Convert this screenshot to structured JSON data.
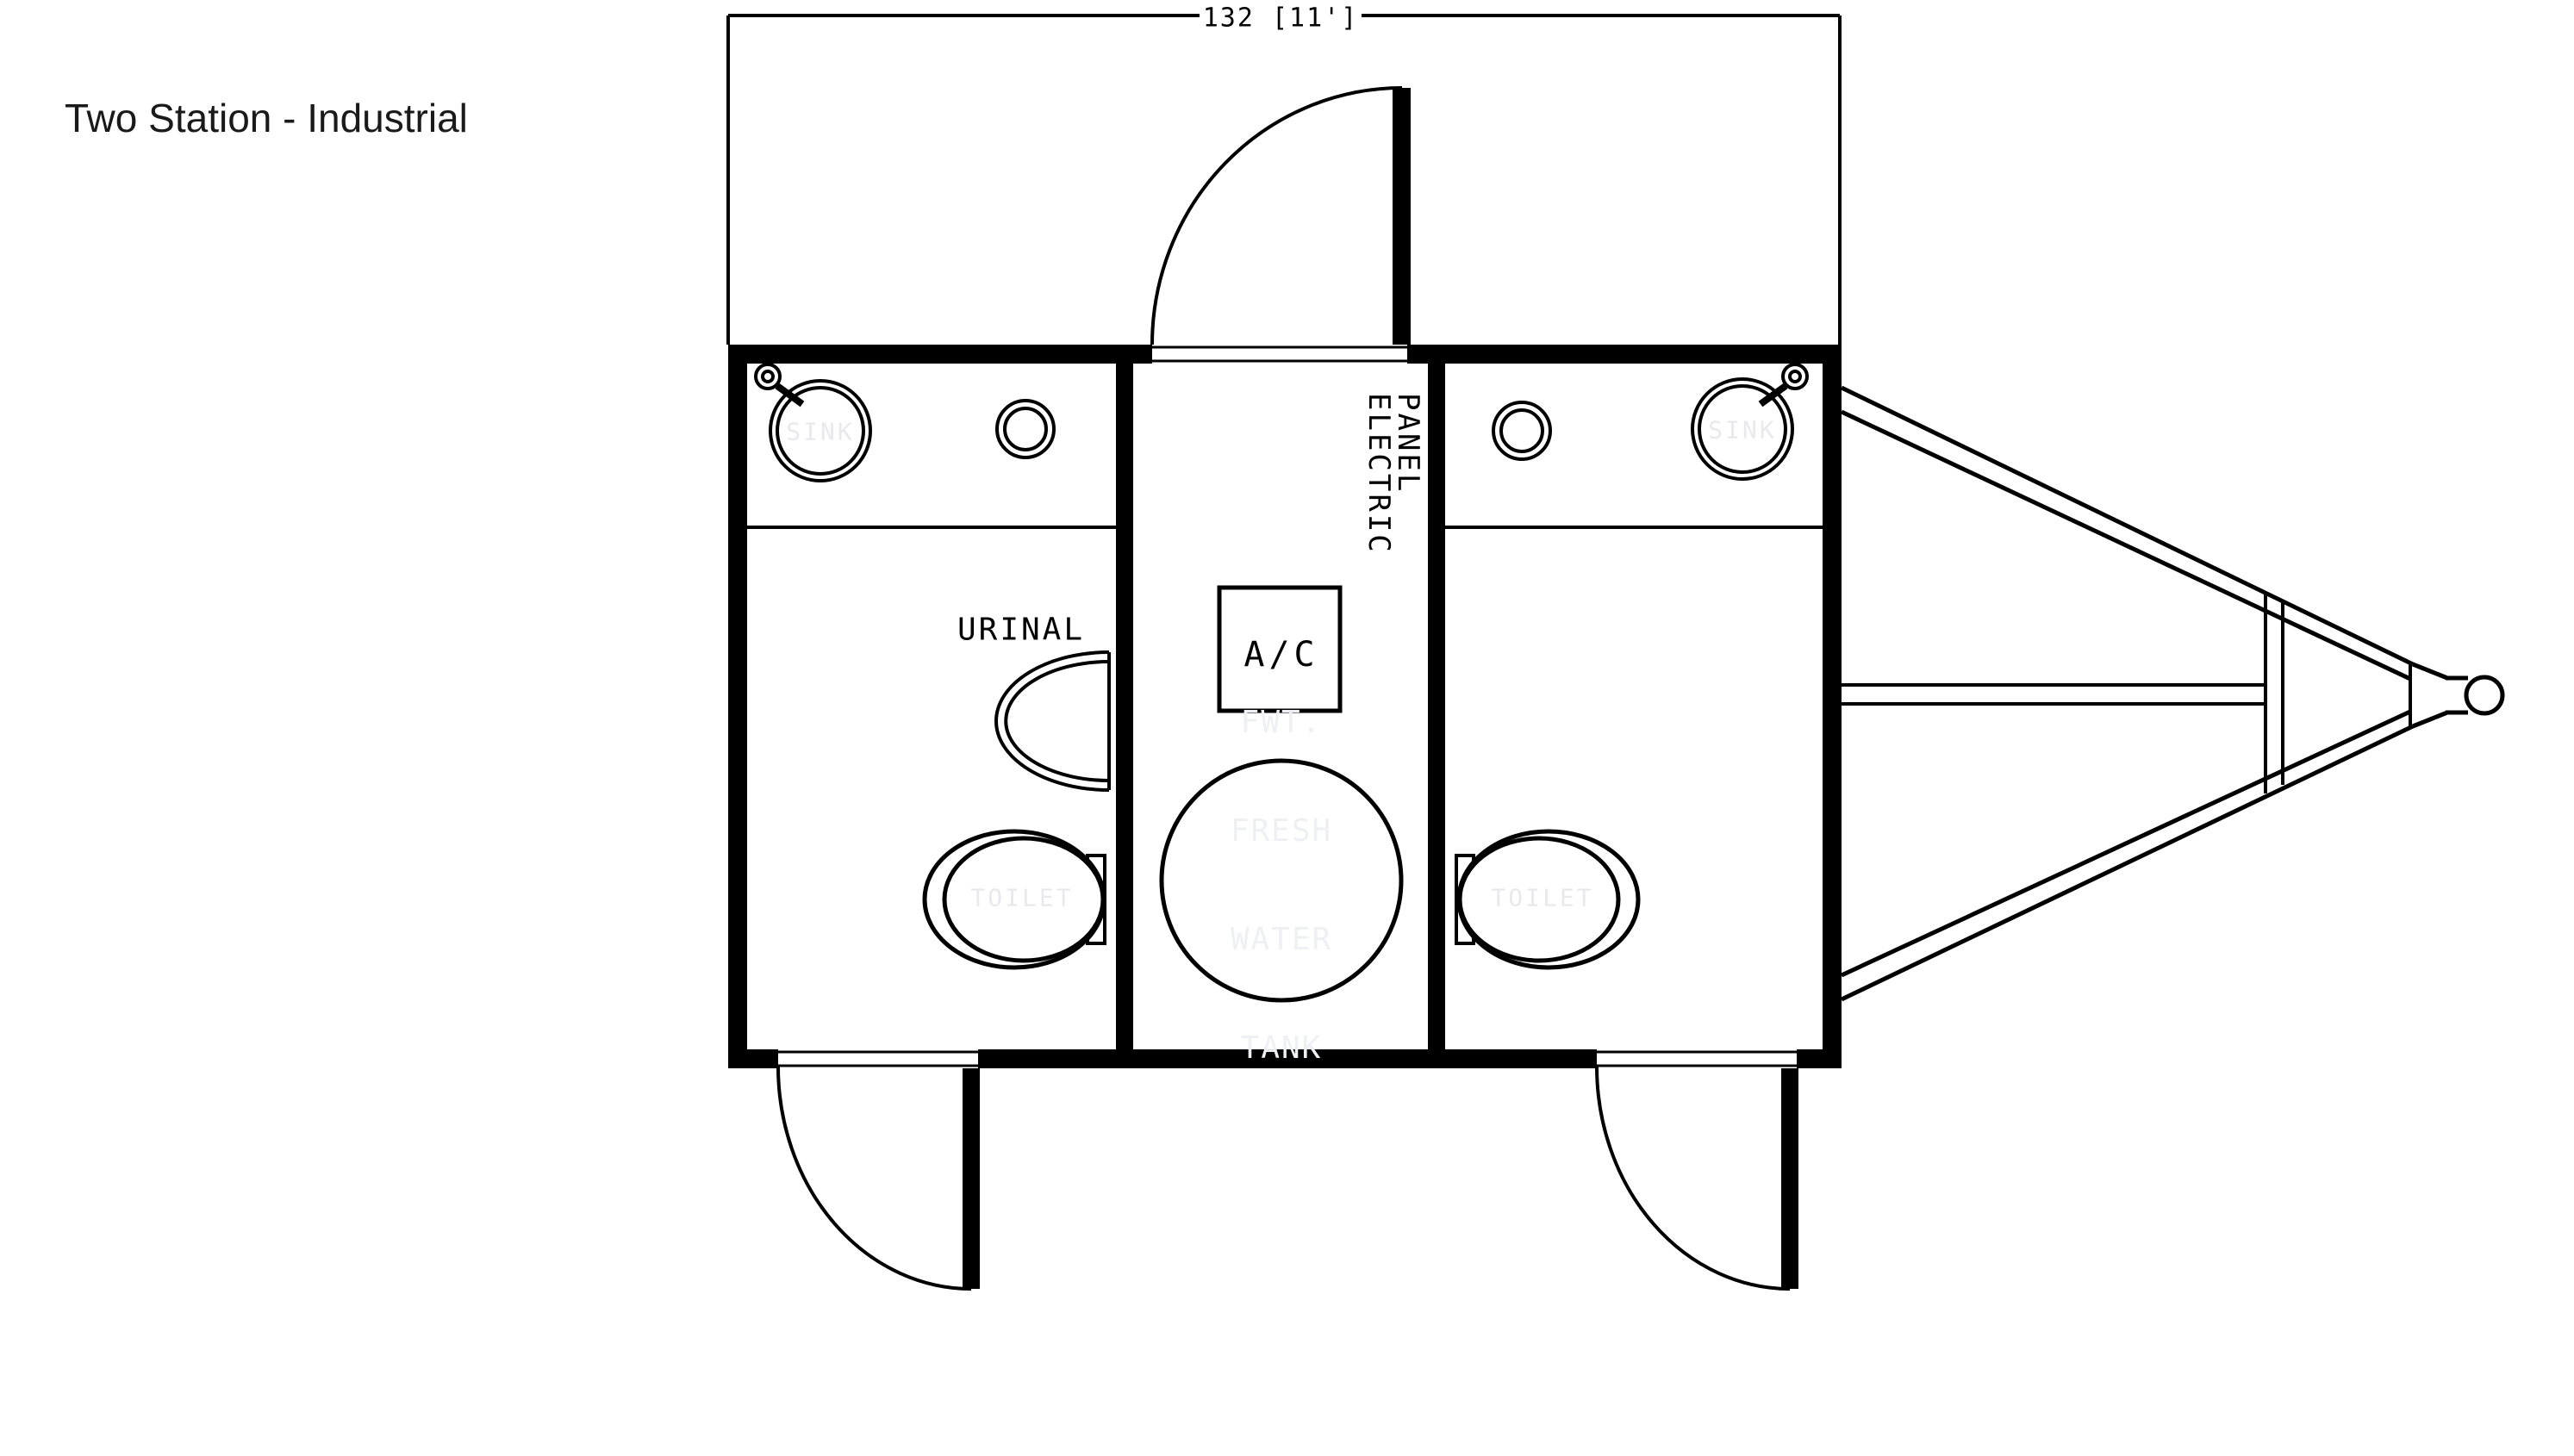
{
  "title": "Two Station - Industrial",
  "dimension": {
    "label": "132 [11']"
  },
  "labels": {
    "urinal": "URINAL",
    "ac_unit": "A/C",
    "electric_panel": {
      "line1": "ELECTRIC",
      "line2": "PANEL"
    },
    "sink_left": "SINK",
    "sink_right": "SINK",
    "toilet_left": "TOILET",
    "toilet_right": "TOILET",
    "fresh_water_tank": {
      "line1": "FWT.",
      "line2": "FRESH",
      "line3": "WATER",
      "line4": "TANK"
    }
  },
  "colors": {
    "line": "#000000",
    "background": "#ffffff",
    "title_text": "#1a1a1a",
    "ghost_text": "#e9e9ed",
    "ghost_text_faint": "#eff0f3"
  }
}
